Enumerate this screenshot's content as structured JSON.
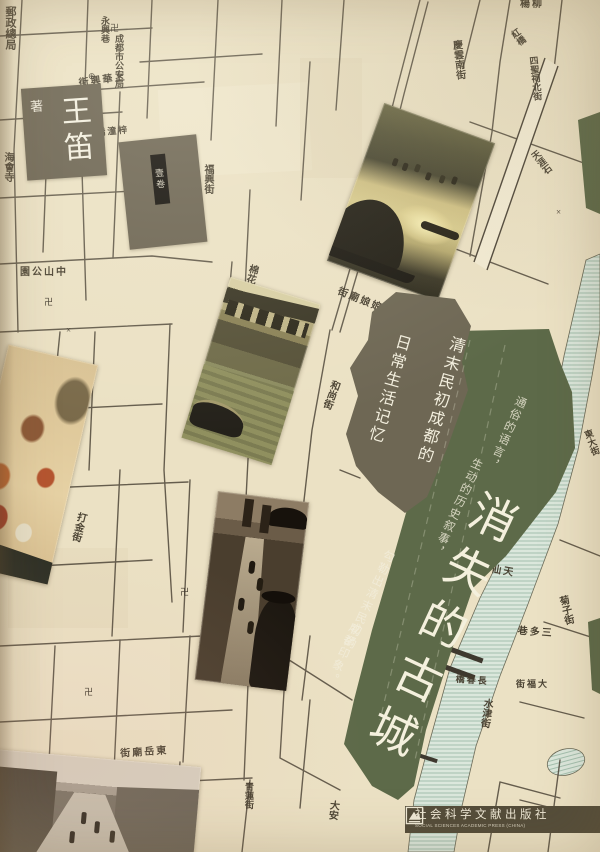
{
  "cover": {
    "author": {
      "role": "著",
      "name": "王笛"
    },
    "series_badge": {
      "label": "壹卷"
    },
    "title": {
      "text": "消失的古城",
      "chars": [
        "消",
        "失",
        "的",
        "古",
        "城"
      ]
    },
    "subtitle": {
      "line1": "清末民初成都的",
      "line2": "日常生活记忆"
    },
    "tagline": {
      "col1": "通俗的语言，",
      "col2": "生动的历史叙事，",
      "col3": "勾勒出清末民初的",
      "col4": "成都印象。"
    },
    "publisher": {
      "name_cn": "社会科学文献出版社",
      "name_en": "SOCIAL SCIENCES ACADEMIC PRESS (CHINA)"
    }
  },
  "colors": {
    "map_cream": "#ebe1c4",
    "ink": "#4e4639",
    "banner_green": "#5d6a49",
    "subtitle_block": "#6e6754",
    "author_box": "#6a6250",
    "publisher_bar": "#544d3a",
    "river": "#d9e6da",
    "title_text": "#f4f0dd"
  },
  "map": {
    "labels": [
      {
        "text": "郵政總局",
        "x": 4,
        "y": 6,
        "v": 1,
        "s": 11
      },
      {
        "text": "海會寺",
        "x": 2,
        "y": 152,
        "v": 1,
        "s": 10
      },
      {
        "text": "永興巷",
        "x": 100,
        "y": 16,
        "v": 1,
        "s": 9
      },
      {
        "text": "成都市公安局",
        "x": 114,
        "y": 34,
        "v": 1,
        "s": 9
      },
      {
        "text": "街興華上",
        "x": 78,
        "y": 76,
        "v": 0,
        "s": 10,
        "r": -8
      },
      {
        "text": "福興街",
        "x": 202,
        "y": 164,
        "v": 1,
        "s": 10
      },
      {
        "text": "街西橋潼梓",
        "x": 74,
        "y": 128,
        "v": 0,
        "s": 9,
        "r": -5
      },
      {
        "text": "園公山中",
        "x": 20,
        "y": 268,
        "v": 0,
        "s": 10
      },
      {
        "text": "棉花街",
        "x": 248,
        "y": 264,
        "v": 1,
        "s": 10,
        "r": 15
      },
      {
        "text": "江南館街",
        "x": 196,
        "y": 396,
        "v": 1,
        "s": 9,
        "r": 5
      },
      {
        "text": "北糠市街",
        "x": 270,
        "y": 418,
        "v": 1,
        "s": 9,
        "r": 18
      },
      {
        "text": "和尚街",
        "x": 330,
        "y": 380,
        "v": 1,
        "s": 10,
        "r": 20
      },
      {
        "text": "街廟娘娘",
        "x": 338,
        "y": 296,
        "v": 0,
        "s": 10,
        "r": 22
      },
      {
        "text": "春熙路南",
        "x": 24,
        "y": 358,
        "v": 1,
        "s": 9,
        "r": 6
      },
      {
        "text": "新學巷",
        "x": 8,
        "y": 388,
        "v": 1,
        "s": 9
      },
      {
        "text": "打金街",
        "x": 76,
        "y": 512,
        "v": 1,
        "s": 10,
        "r": 14
      },
      {
        "text": "巷仙天",
        "x": 480,
        "y": 566,
        "v": 0,
        "s": 10,
        "r": 10
      },
      {
        "text": "巷多三",
        "x": 518,
        "y": 628,
        "v": 0,
        "s": 10,
        "r": 4
      },
      {
        "text": "菊子街",
        "x": 556,
        "y": 596,
        "v": 1,
        "s": 10,
        "r": -14
      },
      {
        "text": "橋春長",
        "x": 456,
        "y": 676,
        "v": 0,
        "s": 9,
        "r": 4
      },
      {
        "text": "街福大",
        "x": 516,
        "y": 680,
        "v": 0,
        "s": 9
      },
      {
        "text": "水津街",
        "x": 482,
        "y": 698,
        "v": 1,
        "s": 10,
        "r": 8
      },
      {
        "text": "大安",
        "x": 328,
        "y": 800,
        "v": 1,
        "s": 10,
        "r": 6
      },
      {
        "text": "街廟岳東",
        "x": 120,
        "y": 748,
        "v": 0,
        "s": 10,
        "r": -4
      },
      {
        "text": "池蓮",
        "x": 70,
        "y": 760,
        "v": 0,
        "s": 9
      },
      {
        "text": "青蓮街",
        "x": 244,
        "y": 782,
        "v": 1,
        "s": 9
      },
      {
        "text": "慶雲南街",
        "x": 450,
        "y": 40,
        "v": 1,
        "s": 10,
        "r": -6
      },
      {
        "text": "四聖祠北街",
        "x": 528,
        "y": 56,
        "v": 1,
        "s": 9,
        "r": -6
      },
      {
        "text": "紅橋",
        "x": 508,
        "y": 30,
        "v": 1,
        "s": 9,
        "r": -35
      },
      {
        "text": "楊柳",
        "x": 520,
        "y": 0,
        "v": 0,
        "s": 10
      },
      {
        "text": "天涯石",
        "x": 528,
        "y": 152,
        "v": 1,
        "s": 9,
        "r": -38
      },
      {
        "text": "東大街",
        "x": 582,
        "y": 430,
        "v": 1,
        "s": 9,
        "r": -20
      }
    ],
    "symbols": [
      {
        "g": "卍",
        "x": 110,
        "y": 24
      },
      {
        "g": "卍",
        "x": 44,
        "y": 298
      },
      {
        "g": "卍",
        "x": 336,
        "y": 246
      },
      {
        "g": "卍",
        "x": 180,
        "y": 588
      },
      {
        "g": "卍",
        "x": 396,
        "y": 712
      },
      {
        "g": "卍",
        "x": 84,
        "y": 688
      },
      {
        "g": "卍",
        "x": 262,
        "y": 540
      },
      {
        "g": "⊕",
        "x": 88,
        "y": 72
      },
      {
        "g": "×",
        "x": 66,
        "y": 326
      },
      {
        "g": "×",
        "x": 556,
        "y": 208
      }
    ]
  }
}
